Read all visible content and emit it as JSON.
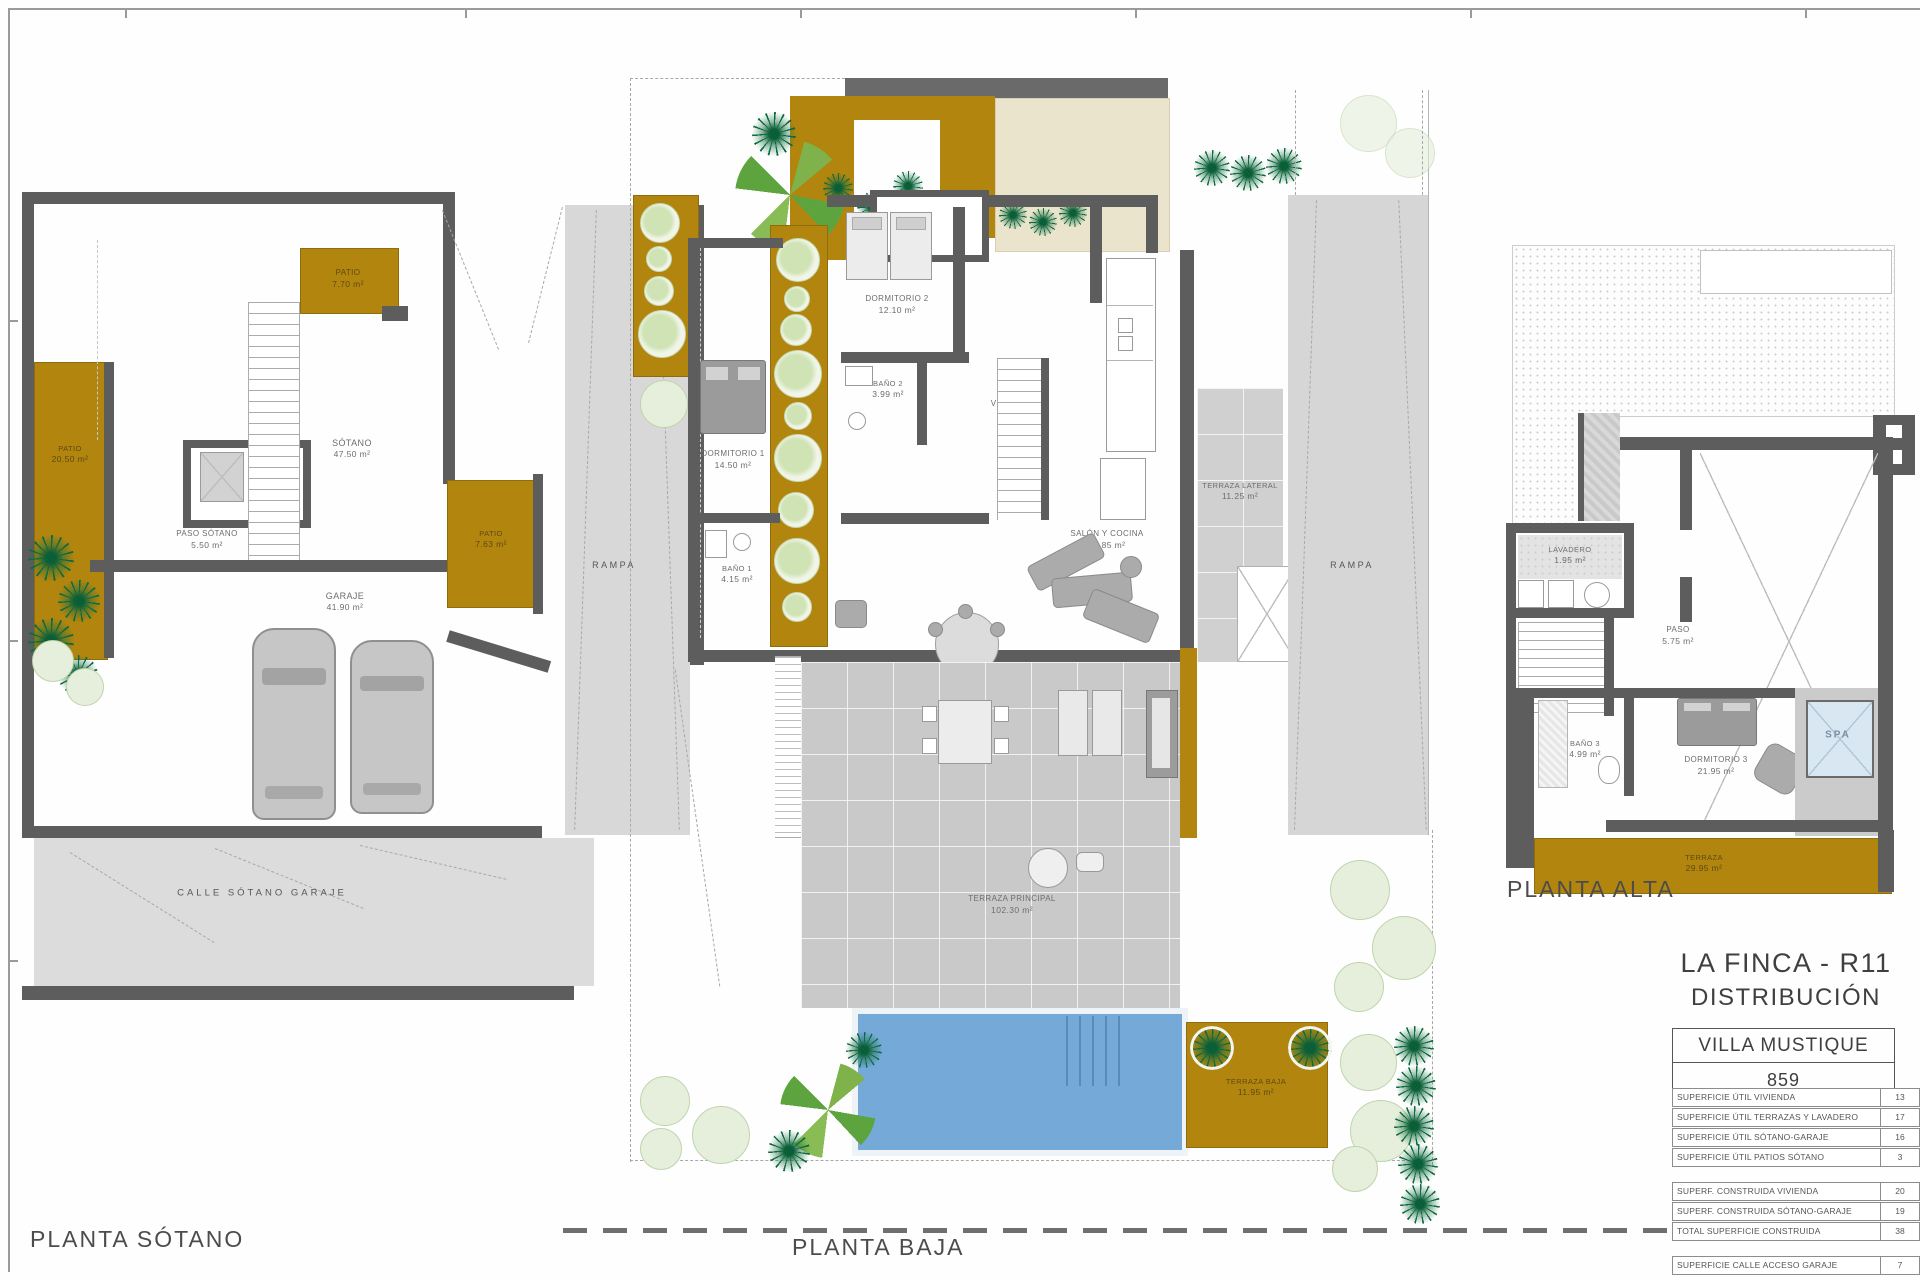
{
  "sheet": {
    "project_line1": "LA FINCA - R11",
    "project_line2": "DISTRIBUCIÓN",
    "villa_name": "VILLA MUSTIQUE",
    "villa_number": "859"
  },
  "plans": {
    "sotano": {
      "title": "PLANTA SÓTANO",
      "rooms": {
        "patio_top": {
          "name": "PATIO",
          "area": "7.70 m²"
        },
        "patio_left": {
          "name": "PATIO",
          "area": "20.50 m²"
        },
        "patio_right": {
          "name": "PATIO",
          "area": "7.63 m²"
        },
        "sotano": {
          "name": "SÓTANO",
          "area": "47.50 m²"
        },
        "paso": {
          "name": "PASO SÓTANO",
          "area": "5.50 m²"
        },
        "garaje": {
          "name": "GARAJE",
          "area": "41.90 m²"
        },
        "rampa": {
          "name": "RAMPA"
        },
        "calle": {
          "name": "CALLE SÓTANO GARAJE"
        }
      }
    },
    "baja": {
      "title": "PLANTA BAJA",
      "rooms": {
        "dormitorio2": {
          "name": "DORMITORIO 2",
          "area": "12.10 m²"
        },
        "bano2": {
          "name": "BAÑO 2",
          "area": "3.99 m²"
        },
        "vestibulo": {
          "name": "VESTÍBULO",
          "area": "5.30 m²"
        },
        "dormitorio1": {
          "name": "DORMITORIO 1",
          "area": "14.50 m²"
        },
        "bano1": {
          "name": "BAÑO 1",
          "area": "4.15 m²"
        },
        "salon": {
          "name": "SALÓN Y COCINA",
          "area": "27.85 m²"
        },
        "terraza_lateral": {
          "name": "TERRAZA LATERAL",
          "area": "11.25 m²"
        },
        "terraza_principal": {
          "name": "TERRAZA PRINCIPAL",
          "area": "102.30 m²"
        },
        "terraza_baja": {
          "name": "TERRAZA BAJA",
          "area": "11.95 m²"
        },
        "rampa": {
          "name": "RAMPA"
        }
      }
    },
    "alta": {
      "title": "PLANTA ALTA",
      "rooms": {
        "lavadero": {
          "name": "LAVADERO",
          "area": "1.95 m²"
        },
        "paso": {
          "name": "PASO",
          "area": "5.75 m²"
        },
        "bano3": {
          "name": "BAÑO 3",
          "area": "4.99 m²"
        },
        "dormitorio3": {
          "name": "DORMITORIO 3",
          "area": "21.95 m²"
        },
        "spa": {
          "name": "SPA"
        },
        "terraza": {
          "name": "TERRAZA",
          "area": "29.95 m²"
        }
      }
    }
  },
  "area_tables": {
    "util": {
      "rows": [
        {
          "label": "SUPERFICIE ÚTIL VIVIENDA",
          "value": "13"
        },
        {
          "label": "SUPERFICIE ÚTIL TERRAZAS Y LAVADERO",
          "value": "17"
        },
        {
          "label": "SUPERFICIE ÚTIL SÓTANO-GARAJE",
          "value": "16"
        },
        {
          "label": "SUPERFICIE ÚTIL PATIOS SÓTANO",
          "value": "3"
        }
      ]
    },
    "construida": {
      "rows": [
        {
          "label": "SUPERF. CONSTRUIDA VIVIENDA",
          "value": "20"
        },
        {
          "label": "SUPERF. CONSTRUIDA SÓTANO-GARAJE",
          "value": "19"
        },
        {
          "label": "TOTAL SUPERFICIE CONSTRUIDA",
          "value": "38"
        }
      ]
    },
    "acceso": {
      "rows": [
        {
          "label": "SUPERFICIE CALLE ACCESO GARAJE",
          "value": "7"
        }
      ]
    }
  },
  "colors": {
    "ochre": "#b2850e",
    "wall": "#5d5d5d",
    "pool": "#74a9d8",
    "spa": "#d8e7f1",
    "terrace_gray": "#c9c9c9",
    "street_gray": "#dadada",
    "cream": "#ebe4cd",
    "tree_green": "#0e6b40",
    "bush_green": "#cfe3b4"
  }
}
